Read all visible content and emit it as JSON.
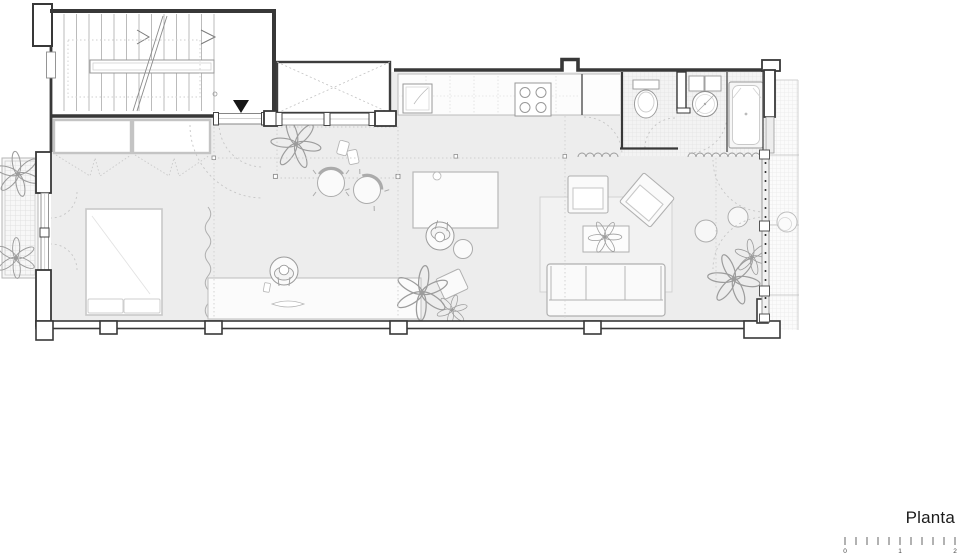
{
  "title": "Planta",
  "scale_bar": {
    "labels": [
      "0",
      "1",
      "2"
    ],
    "tick_count": 11,
    "units_shown": "meters"
  },
  "colors": {
    "background": "#ffffff",
    "floor": "#ededed",
    "wall": "#383838",
    "furniture_line": "#b0b0b0",
    "tile_line": "#dedede",
    "entry_marker": "#161616"
  },
  "plan_elements": [
    "staircase",
    "entry-arrow",
    "entry-door",
    "patio-lightwell",
    "kitchen-counter",
    "sink",
    "hob",
    "bathroom",
    "toilet",
    "washbasin",
    "bathtub-shower",
    "wardrobes",
    "bed",
    "curtain",
    "desk",
    "person-at-desk",
    "dining-table",
    "person-at-table",
    "round-chairs",
    "stool",
    "rug",
    "sofa",
    "armchairs",
    "coffee-table",
    "poufs",
    "plants",
    "balcony",
    "terrace-gallery",
    "glazed-facade"
  ]
}
